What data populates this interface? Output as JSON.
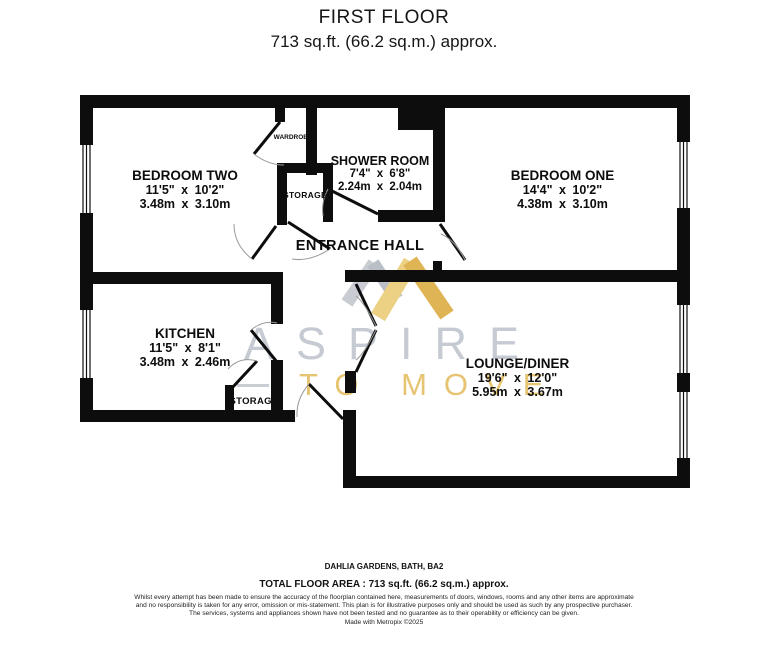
{
  "title": {
    "floor": "FIRST FLOOR",
    "area": "713 sq.ft. (66.2 sq.m.) approx."
  },
  "rooms": {
    "bedroom_two": {
      "name": "BEDROOM TWO",
      "imperial": "11'5\" x 10'2\"",
      "metric": "3.48m x 3.10m"
    },
    "shower_room": {
      "name": "SHOWER ROOM",
      "imperial": "7'4\" x 6'8\"",
      "metric": "2.24m x 2.04m"
    },
    "bedroom_one": {
      "name": "BEDROOM ONE",
      "imperial": "14'4\" x 10'2\"",
      "metric": "4.38m x 3.10m"
    },
    "kitchen": {
      "name": "KITCHEN",
      "imperial": "11'5\" x 8'1\"",
      "metric": "3.48m x 2.46m"
    },
    "lounge_diner": {
      "name": "LOUNGE/DINER",
      "imperial": "19'6\" x 12'0\"",
      "metric": "5.95m x 3.67m"
    },
    "entrance_hall": {
      "name": "ENTRANCE HALL"
    },
    "storage_hall": {
      "name": "STORAGE"
    },
    "storage_kitchen": {
      "name": "STORAGE"
    },
    "wardrobe": {
      "name": "WARDROBE"
    }
  },
  "watermark": {
    "brand": "ASPIRE",
    "tagline": "TO MOVE",
    "gray": "#c6cbd3",
    "gold": "#e6c472"
  },
  "footer": {
    "address": "DAHLIA GARDENS, BATH, BA2",
    "total_area": "TOTAL FLOOR AREA : 713 sq.ft. (66.2 sq.m.) approx.",
    "disclaimer": "Whilst every attempt has been made to ensure the accuracy of the floorplan contained here, measurements of doors, windows, rooms and any other items are approximate and no responsibility is taken for any error, omission or mis-statement. This plan is for illustrative purposes only and should be used as such by any prospective purchaser. The services, systems and appliances shown have not been tested and no guarantee as to their operability or efficiency can be given.",
    "credit": "Made with Metropix ©2025"
  },
  "colors": {
    "wall": "#0d0d0d"
  }
}
